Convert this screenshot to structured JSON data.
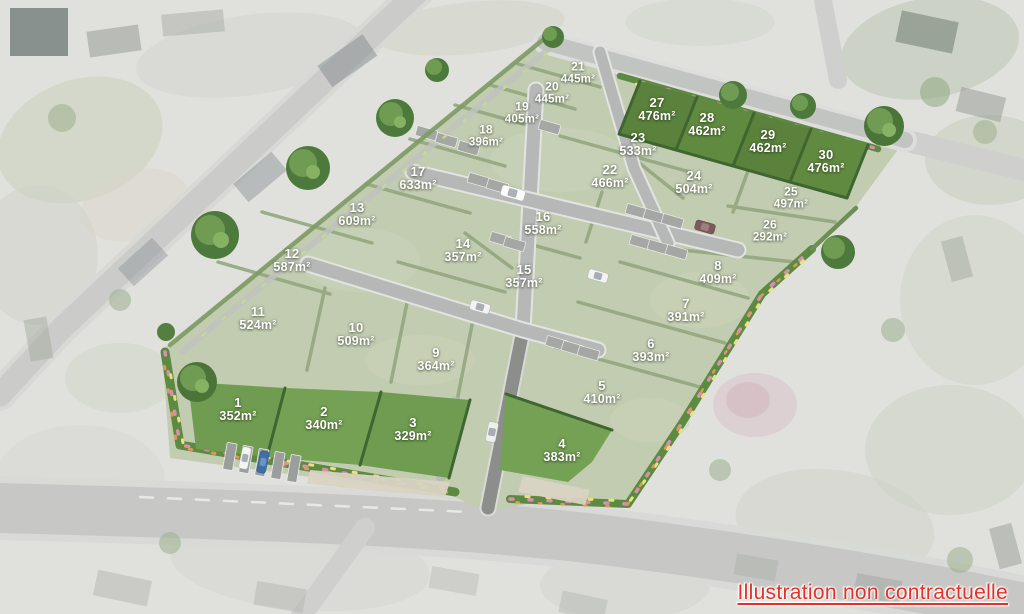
{
  "site_plan": {
    "disclaimer": "Illustration non contractuelle",
    "unit": "m²",
    "colors": {
      "available_lot": "#6f9c50",
      "available_lot_dark": "#5a823c",
      "sold_lot_faded": "#c2ccb1",
      "road": "#b5b8b6",
      "hedge": "#93a77f",
      "disclaimer_text": "#e23128",
      "label_text": "#ffffff"
    },
    "available_lot_numbers": [
      "1",
      "2",
      "3",
      "4",
      "27",
      "28",
      "29",
      "30"
    ],
    "lots": [
      {
        "number": "1",
        "area": "352m²",
        "available": true
      },
      {
        "number": "2",
        "area": "340m²",
        "available": true
      },
      {
        "number": "3",
        "area": "329m²",
        "available": true
      },
      {
        "number": "4",
        "area": "383m²",
        "available": true
      },
      {
        "number": "5",
        "area": "410m²",
        "available": false
      },
      {
        "number": "6",
        "area": "393m²",
        "available": false
      },
      {
        "number": "7",
        "area": "391m²",
        "available": false
      },
      {
        "number": "8",
        "area": "409m²",
        "available": false
      },
      {
        "number": "9",
        "area": "364m²",
        "available": false
      },
      {
        "number": "10",
        "area": "509m²",
        "available": false
      },
      {
        "number": "11",
        "area": "524m²",
        "available": false
      },
      {
        "number": "12",
        "area": "587m²",
        "available": false
      },
      {
        "number": "13",
        "area": "609m²",
        "available": false
      },
      {
        "number": "14",
        "area": "357m²",
        "available": false
      },
      {
        "number": "15",
        "area": "357m²",
        "available": false
      },
      {
        "number": "16",
        "area": "558m²",
        "available": false
      },
      {
        "number": "17",
        "area": "633m²",
        "available": false
      },
      {
        "number": "18",
        "area": "396m²",
        "available": false
      },
      {
        "number": "19",
        "area": "405m²",
        "available": false
      },
      {
        "number": "20",
        "area": "445m²",
        "available": false
      },
      {
        "number": "21",
        "area": "445m²",
        "available": false
      },
      {
        "number": "22",
        "area": "466m²",
        "available": false
      },
      {
        "number": "23",
        "area": "533m²",
        "available": false
      },
      {
        "number": "24",
        "area": "504m²",
        "available": false
      },
      {
        "number": "25",
        "area": "497m²",
        "available": false
      },
      {
        "number": "26",
        "area": "292m²",
        "available": false
      },
      {
        "number": "27",
        "area": "476m²",
        "available": true
      },
      {
        "number": "28",
        "area": "462m²",
        "available": true
      },
      {
        "number": "29",
        "area": "462m²",
        "available": true
      },
      {
        "number": "30",
        "area": "476m²",
        "available": true
      }
    ]
  }
}
